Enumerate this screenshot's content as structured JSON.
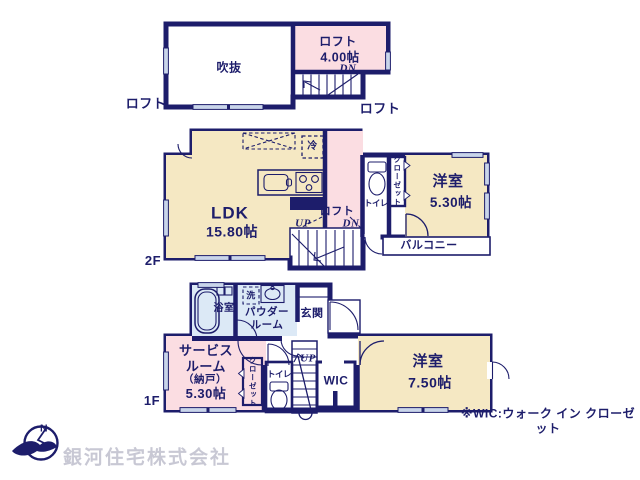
{
  "palette": {
    "wall": "#1d1d6b",
    "room_cream": "#f5e8c3",
    "room_pink": "#fbdde2",
    "room_blue": "#dce9f6",
    "window": "#c9d5ea",
    "company_text": "#c8c8d4"
  },
  "loft": {
    "void_label": "吹抜",
    "room_label": "ロフト",
    "room_size": "4.00帖",
    "dn_label": "DN",
    "outside_label_left": "ロフト",
    "outside_label_right": "ロフト"
  },
  "floor2": {
    "floor_label": "2F",
    "ldk_label": "LDK",
    "ldk_size": "15.80帖",
    "fridge_label": "冷",
    "hall_loft_label": "ロフト",
    "up_label": "UP",
    "dn_label": "DN",
    "toilet_label": "トイレ",
    "closet_label": "クローゼット",
    "bedroom_label": "洋室",
    "bedroom_size": "5.30帖",
    "balcony_label": "バルコニー"
  },
  "floor1": {
    "floor_label": "1F",
    "bath_label": "浴室",
    "laundry_label": "洗",
    "powder_label": "パウダー\nルーム",
    "entrance_label": "玄関",
    "service_name": "サービス\nルーム",
    "service_kura": "（納戸）",
    "service_size": "5.30帖",
    "closet_label": "クローゼット",
    "toilet_label": "トイレ",
    "up_label": "UP",
    "wic_label": "WIC",
    "bedroom_label": "洋室",
    "bedroom_size": "7.50帖"
  },
  "footer": {
    "company": "銀河住宅株式会社",
    "wic_note": "※WIC:ウォーク イン クローゼット",
    "compass_n": "N"
  }
}
